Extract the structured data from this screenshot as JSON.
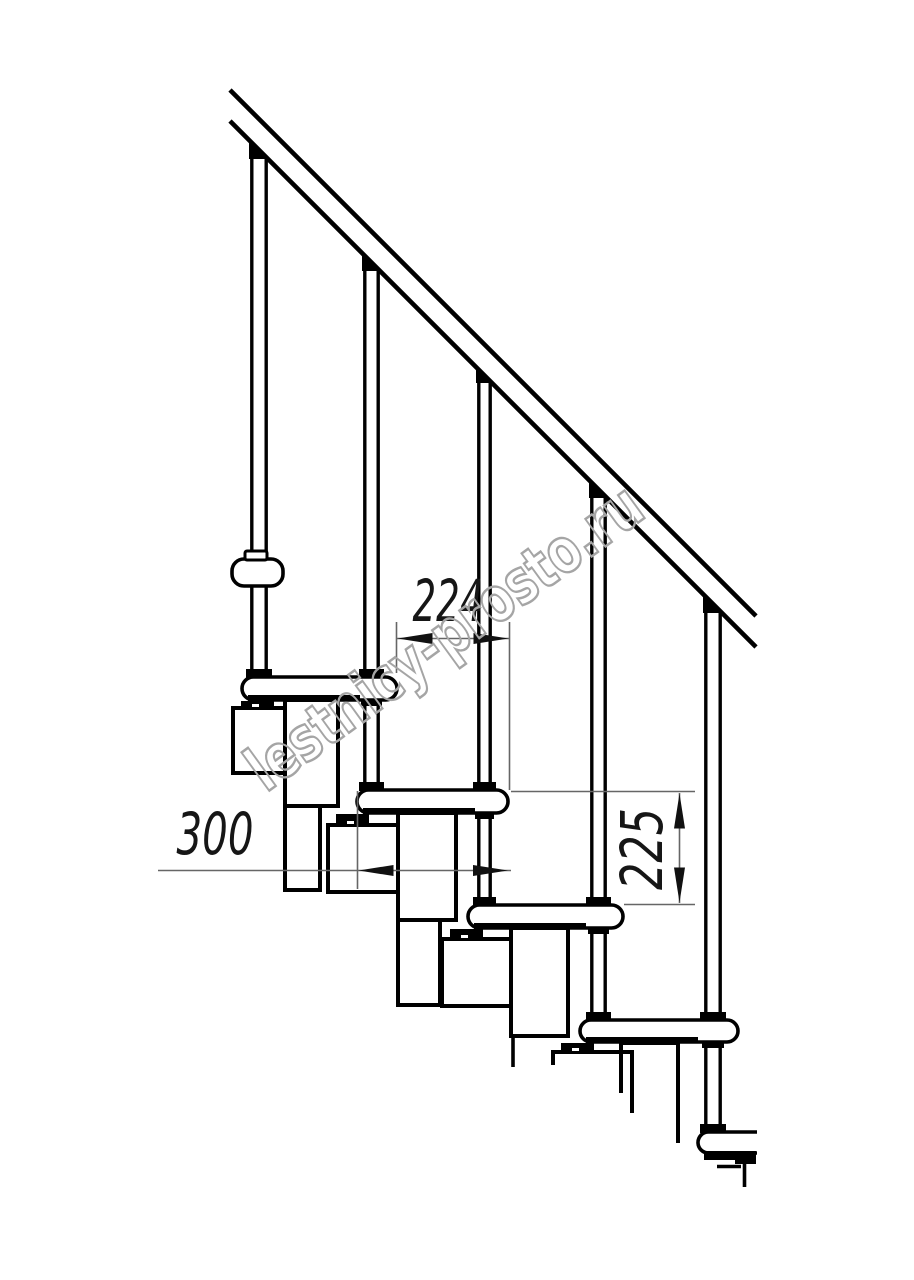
{
  "page": {
    "width": 914,
    "height": 1280,
    "background": "#ffffff"
  },
  "watermark": {
    "text": "lestnicy-prosto.ru",
    "color": "#a5a5a5",
    "x": 266,
    "y": 793,
    "angle": -36,
    "font_size": 62,
    "text_length": 472,
    "stroke_width": 2.5
  },
  "drawing": {
    "line_color": "#000000",
    "dim_line_color": "#666666",
    "dim_text_color": "#161616",
    "fill_color": "#ffffff",
    "rail": {
      "x1": 230,
      "y1": 90,
      "x2": 756,
      "y2": 616,
      "gap": 31,
      "stroke": 4.6
    },
    "balusters": [
      {
        "x": 250,
        "w": 18,
        "bottom": 679
      },
      {
        "x": 363,
        "w": 17,
        "bottom": 792
      },
      {
        "x": 477,
        "w": 15,
        "bottom": 907
      },
      {
        "x": 590,
        "w": 17,
        "bottom": 1022
      },
      {
        "x": 704,
        "w": 18,
        "bottom": 1134
      }
    ],
    "treads": [
      {
        "x": 242,
        "y": 677,
        "w": 155,
        "h": 23
      },
      {
        "x": 357,
        "y": 790,
        "w": 151,
        "h": 23
      },
      {
        "x": 468,
        "y": 905,
        "w": 155,
        "h": 23
      },
      {
        "x": 580,
        "y": 1020,
        "w": 158,
        "h": 22
      },
      {
        "x": 698,
        "y": 1132,
        "w": 59,
        "h": 21,
        "clip_right": true
      }
    ],
    "squares": [
      {
        "x": 233,
        "y": 708,
        "w": 59,
        "h": 65
      },
      {
        "x": 328,
        "y": 825,
        "w": 74,
        "h": 67
      },
      {
        "x": 442,
        "y": 939,
        "w": 76,
        "h": 67
      },
      {
        "x": 553,
        "y": 1052,
        "w": 79,
        "h": 61,
        "clipped": true
      }
    ],
    "tubes": [
      {
        "x": 285,
        "y": 700,
        "w": 53,
        "h": 106,
        "ext_w": 35,
        "ext_h": 84
      },
      {
        "x": 398,
        "y": 813,
        "w": 58,
        "h": 107,
        "ext_w": 42,
        "ext_h": 85
      },
      {
        "x": 511,
        "y": 928,
        "w": 57,
        "h": 108,
        "ext_w": 36,
        "ext_h": 31,
        "ext_open": true
      },
      {
        "x": 621,
        "y": 1043,
        "w": 57,
        "clipped": true,
        "left_end": 1093,
        "right_end": 1143
      }
    ],
    "bracket": {
      "x": 232,
      "y": 559,
      "w": 51,
      "h": 27,
      "r": 12,
      "collar": {
        "x": 245,
        "y": 551,
        "w": 22,
        "h": 9
      }
    },
    "step5_extra": {
      "strip": {
        "x": 704,
        "y": 1151,
        "w": 51,
        "h": 9
      },
      "block": {
        "x": 735,
        "y": 1151,
        "w": 21,
        "h": 13
      },
      "lines": [
        "M717,1166.5 H741",
        "M744.5,1160 V1187"
      ]
    }
  },
  "dimensions": [
    {
      "id": "run",
      "value": "224",
      "line": {
        "x1": 396.5,
        "y1": 638.5,
        "x2": 509.5,
        "y2": 638.5
      },
      "ext": [
        {
          "x1": 396.5,
          "y1": 622,
          "x2": 396.5,
          "y2": 673
        },
        {
          "x1": 509.5,
          "y1": 622,
          "x2": 509.5,
          "y2": 790
        }
      ],
      "arrows": [
        {
          "x": 397.5,
          "y": 638.5,
          "dir": "left"
        },
        {
          "x": 508.5,
          "y": 638.5,
          "dir": "right"
        }
      ],
      "label": {
        "x": 448,
        "y": 621,
        "rotate": 0,
        "length": 71
      }
    },
    {
      "id": "depth",
      "value": "300",
      "line": {
        "x1": 158,
        "y1": 870.5,
        "x2": 511,
        "y2": 870.5
      },
      "ext": [
        {
          "x1": 357.5,
          "y1": 791,
          "x2": 357.5,
          "y2": 889
        }
      ],
      "arrows": [
        {
          "x": 358.5,
          "y": 870.5,
          "dir": "left"
        },
        {
          "x": 508,
          "y": 870.5,
          "dir": "right"
        }
      ],
      "label": {
        "x": 215,
        "y": 854,
        "rotate": 0,
        "length": 77
      }
    },
    {
      "id": "rise",
      "value": "225",
      "line": {
        "x1": 679.5,
        "y1": 793,
        "x2": 679.5,
        "y2": 903
      },
      "ext": [
        {
          "x1": 511,
          "y1": 791.5,
          "x2": 695,
          "y2": 791.5
        },
        {
          "x1": 624,
          "y1": 904.5,
          "x2": 695,
          "y2": 904.5
        }
      ],
      "arrows": [
        {
          "x": 679.5,
          "y": 793.5,
          "dir": "up"
        },
        {
          "x": 679.5,
          "y": 902.5,
          "dir": "down"
        }
      ],
      "label": {
        "x": 662,
        "y": 849,
        "rotate": -90,
        "length": 82
      }
    }
  ]
}
